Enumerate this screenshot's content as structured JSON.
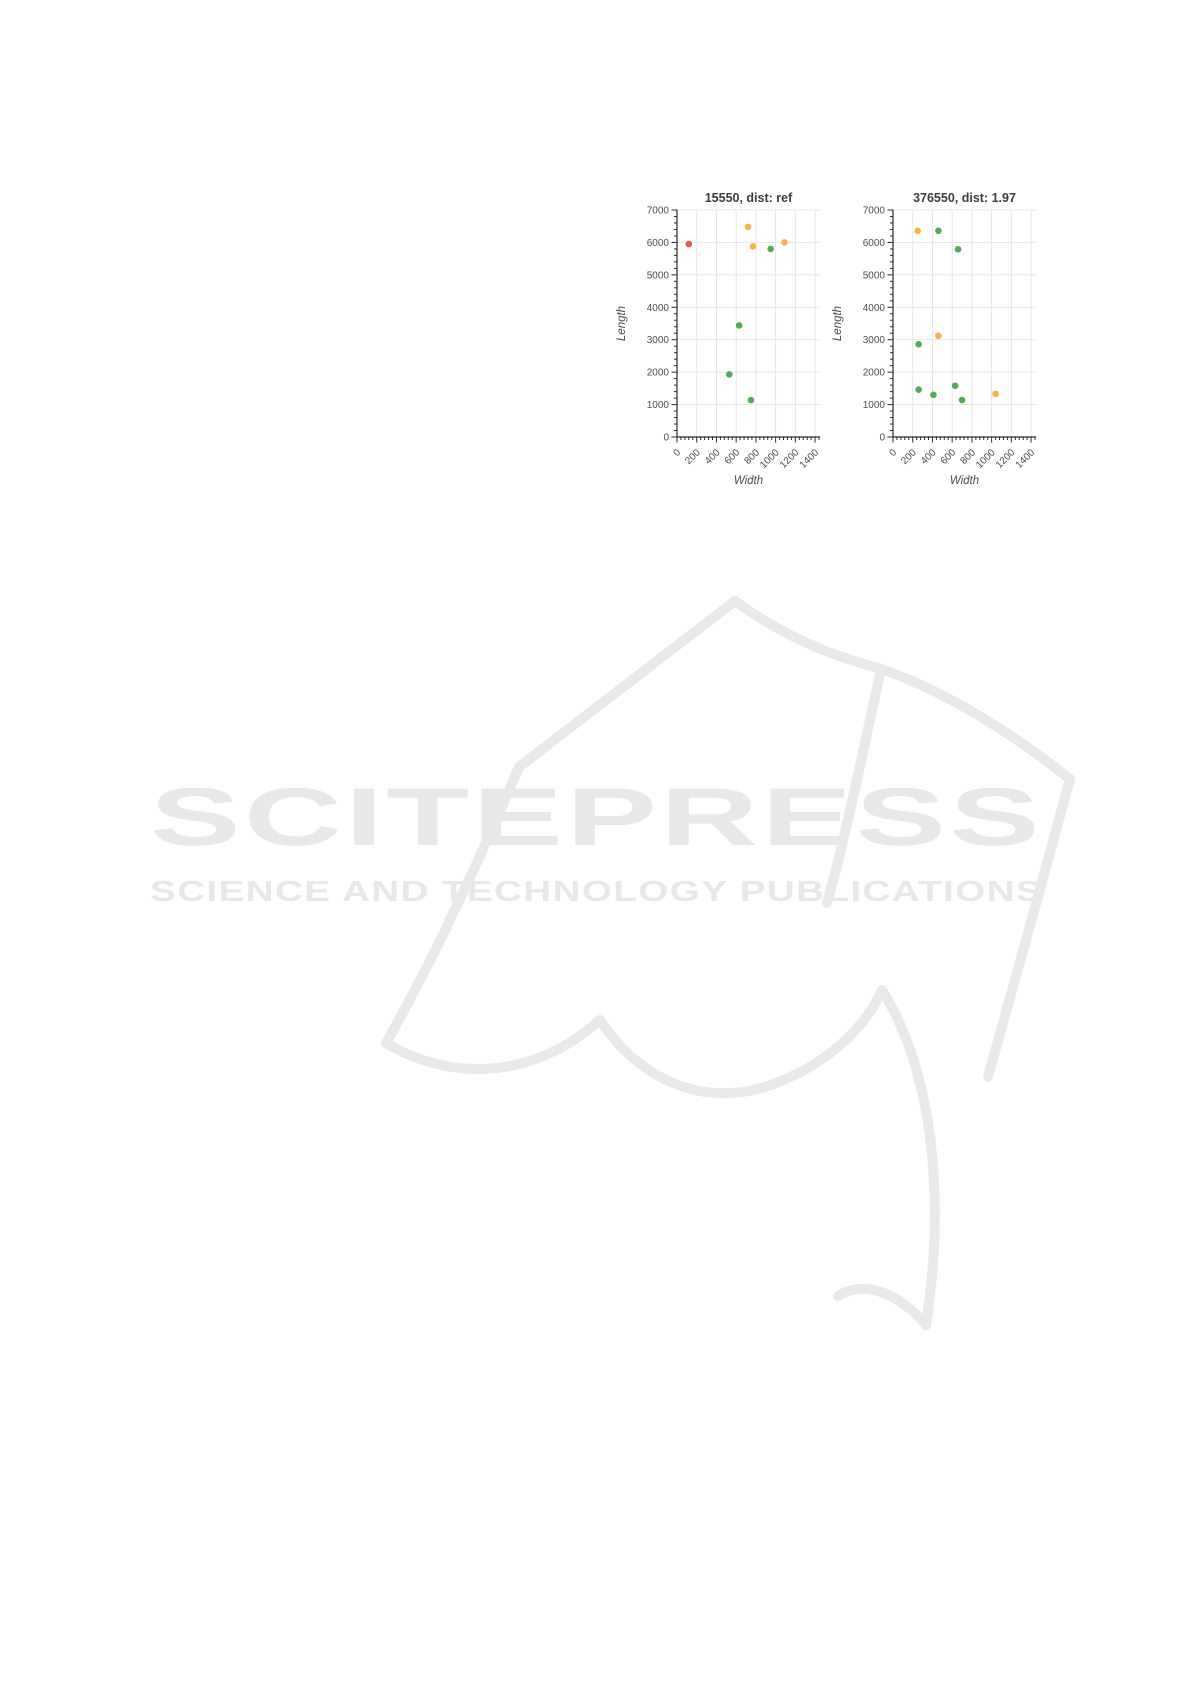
{
  "page": {
    "width_px": 1191,
    "height_px": 1684,
    "background": "#ffffff"
  },
  "watermark": {
    "line1": "SCITEPRESS",
    "line2": "SCIENCE AND TECHNOLOGY PUBLICATIONS",
    "text_color": "#e8e8e8",
    "book_outline_color": "#e9e9e9"
  },
  "style": {
    "point_colors": {
      "red": "#e8534e",
      "orange": "#fbad3f",
      "green": "#4aa54e"
    },
    "grid_color": "#e4e4e4",
    "axis_color": "#2b2b2b",
    "tick_label_color": "#4d4d4d",
    "title_color": "#3d3d3d",
    "axis_label_color": "#4d4d4d"
  },
  "chart_data": [
    {
      "type": "scatter",
      "title": "15550, dist: ref",
      "xlabel": "Width",
      "ylabel": "Length",
      "xlim": [
        0,
        1450
      ],
      "ylim": [
        0,
        7000
      ],
      "xticks": [
        0,
        200,
        400,
        600,
        800,
        1000,
        1200,
        1400
      ],
      "yticks": [
        0,
        1000,
        2000,
        3000,
        4000,
        5000,
        6000,
        7000
      ],
      "x_minor_step": 40,
      "y_minor_step": 200,
      "grid": true,
      "legend": "none",
      "series": [
        {
          "name": "reference-point",
          "color": "red",
          "points": [
            [
              120,
              5950
            ]
          ]
        },
        {
          "name": "cluster-orange",
          "color": "orange",
          "points": [
            [
              720,
              6480
            ],
            [
              770,
              5880
            ],
            [
              1090,
              6000
            ]
          ]
        },
        {
          "name": "cluster-green",
          "color": "green",
          "points": [
            [
              950,
              5800
            ],
            [
              630,
              3440
            ],
            [
              530,
              1930
            ],
            [
              750,
              1140
            ]
          ]
        }
      ]
    },
    {
      "type": "scatter",
      "title": "376550, dist: 1.97",
      "xlabel": "Width",
      "ylabel": "Length",
      "xlim": [
        0,
        1450
      ],
      "ylim": [
        0,
        7000
      ],
      "xticks": [
        0,
        200,
        400,
        600,
        800,
        1000,
        1200,
        1400
      ],
      "yticks": [
        0,
        1000,
        2000,
        3000,
        4000,
        5000,
        6000,
        7000
      ],
      "x_minor_step": 40,
      "y_minor_step": 200,
      "grid": true,
      "legend": "none",
      "series": [
        {
          "name": "cluster-orange",
          "color": "orange",
          "points": [
            [
              250,
              6360
            ],
            [
              460,
              3120
            ],
            [
              1040,
              1330
            ]
          ]
        },
        {
          "name": "cluster-green",
          "color": "green",
          "points": [
            [
              460,
              6360
            ],
            [
              660,
              5790
            ],
            [
              260,
              2860
            ],
            [
              260,
              1460
            ],
            [
              410,
              1300
            ],
            [
              630,
              1580
            ],
            [
              700,
              1140
            ]
          ]
        }
      ]
    }
  ]
}
